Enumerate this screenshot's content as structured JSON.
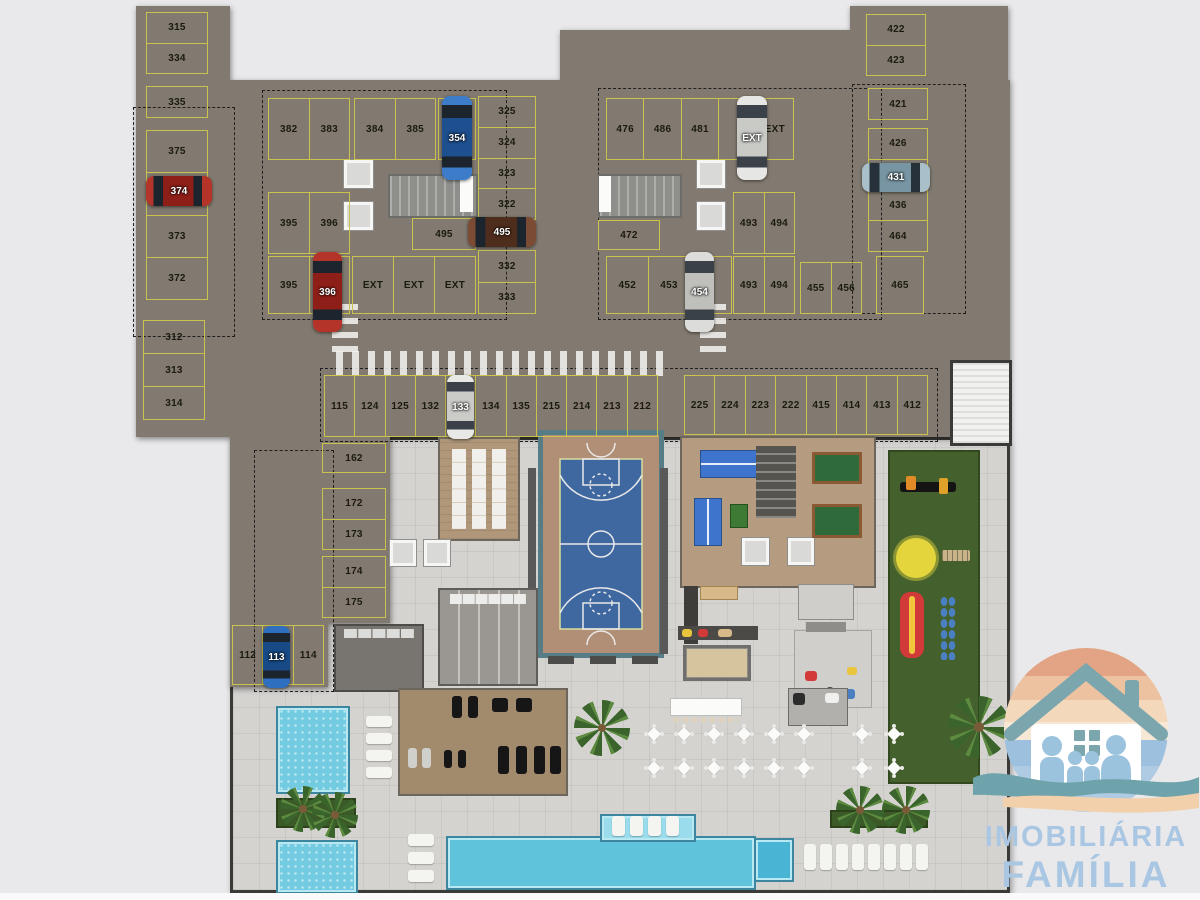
{
  "logo": {
    "line1": "IMOBILIÁRIA",
    "line2": "FAMÍLIA",
    "text_color": "#a9c7e2"
  },
  "colors": {
    "stall_line": "#c9c24c",
    "garage_floor": "#827a70",
    "deck_floor": "#d4d3d0",
    "pool_water": "#72cbe1",
    "court_blue": "#3f67a0",
    "court_tan": "#b18f76",
    "playground_green": "#44602c",
    "logo_text": "#a9c7e2"
  },
  "parking": {
    "groups": [
      {
        "name": "left-col-top",
        "x": 146,
        "y": 12,
        "w": 62,
        "h": 62,
        "dir": "col",
        "labels": [
          "315",
          "334"
        ]
      },
      {
        "name": "left-col-335",
        "x": 146,
        "y": 86,
        "w": 62,
        "h": 32,
        "dir": "col",
        "labels": [
          "335"
        ]
      },
      {
        "name": "left-col-mid",
        "x": 146,
        "y": 130,
        "w": 62,
        "h": 170,
        "dir": "col",
        "labels": [
          "375",
          "374",
          "373",
          "372"
        ]
      },
      {
        "name": "left-col-bottom",
        "x": 143,
        "y": 320,
        "w": 62,
        "h": 100,
        "dir": "col",
        "labels": [
          "312",
          "313",
          "314"
        ]
      },
      {
        "name": "blockL-row1a",
        "x": 268,
        "y": 98,
        "w": 82,
        "h": 62,
        "dir": "row",
        "labels": [
          "382",
          "383"
        ]
      },
      {
        "name": "blockL-row1b",
        "x": 354,
        "y": 98,
        "w": 82,
        "h": 62,
        "dir": "row",
        "labels": [
          "384",
          "385"
        ]
      },
      {
        "name": "blockL-354",
        "x": 438,
        "y": 98,
        "w": 38,
        "h": 62,
        "dir": "row",
        "labels": [
          ""
        ]
      },
      {
        "name": "blockL-row2",
        "x": 268,
        "y": 192,
        "w": 82,
        "h": 62,
        "dir": "row",
        "labels": [
          "395",
          "396"
        ]
      },
      {
        "name": "blockL-row3",
        "x": 268,
        "y": 256,
        "w": 82,
        "h": 58,
        "dir": "row",
        "labels": [
          "395",
          ""
        ]
      },
      {
        "name": "blockL-ext",
        "x": 352,
        "y": 256,
        "w": 124,
        "h": 58,
        "dir": "row",
        "labels": [
          "EXT",
          "EXT",
          "EXT"
        ]
      },
      {
        "name": "blockL-colR",
        "x": 478,
        "y": 96,
        "w": 58,
        "h": 124,
        "dir": "col",
        "labels": [
          "325",
          "324",
          "323",
          "322"
        ]
      },
      {
        "name": "blockL-495",
        "x": 412,
        "y": 218,
        "w": 64,
        "h": 32,
        "dir": "row",
        "labels": [
          "495"
        ]
      },
      {
        "name": "blockL-colR2",
        "x": 478,
        "y": 250,
        "w": 58,
        "h": 64,
        "dir": "col",
        "labels": [
          "332",
          "333"
        ]
      },
      {
        "name": "blockR-row1",
        "x": 606,
        "y": 98,
        "w": 188,
        "h": 62,
        "dir": "row",
        "labels": [
          "476",
          "486",
          "481",
          "",
          "EXT"
        ]
      },
      {
        "name": "blockR-472",
        "x": 598,
        "y": 220,
        "w": 62,
        "h": 30,
        "dir": "row",
        "labels": [
          "472"
        ]
      },
      {
        "name": "blockR-row3",
        "x": 606,
        "y": 256,
        "w": 126,
        "h": 58,
        "dir": "row",
        "labels": [
          "452",
          "453",
          ""
        ]
      },
      {
        "name": "blockR-493a",
        "x": 733,
        "y": 192,
        "w": 62,
        "h": 62,
        "dir": "row",
        "labels": [
          "493",
          "494"
        ]
      },
      {
        "name": "blockR-493b",
        "x": 733,
        "y": 256,
        "w": 62,
        "h": 58,
        "dir": "row",
        "labels": [
          "493",
          "494"
        ]
      },
      {
        "name": "blockR-455",
        "x": 800,
        "y": 262,
        "w": 62,
        "h": 52,
        "dir": "row",
        "labels": [
          "455",
          "456"
        ]
      },
      {
        "name": "blockR-465",
        "x": 876,
        "y": 256,
        "w": 48,
        "h": 58,
        "dir": "row",
        "labels": [
          "465"
        ]
      },
      {
        "name": "right-col-top",
        "x": 866,
        "y": 14,
        "w": 60,
        "h": 62,
        "dir": "col",
        "labels": [
          "422",
          "423"
        ]
      },
      {
        "name": "right-col-421",
        "x": 868,
        "y": 88,
        "w": 60,
        "h": 32,
        "dir": "col",
        "labels": [
          "421"
        ]
      },
      {
        "name": "right-col-mid",
        "x": 868,
        "y": 128,
        "w": 60,
        "h": 124,
        "dir": "col",
        "labels": [
          "426",
          "",
          "436",
          "464"
        ]
      },
      {
        "name": "mid-strip-left",
        "x": 324,
        "y": 375,
        "w": 334,
        "h": 62,
        "dir": "row",
        "labels": [
          "115",
          "124",
          "125",
          "132",
          "",
          "134",
          "135",
          "215",
          "214",
          "213",
          "212"
        ]
      },
      {
        "name": "mid-strip-right",
        "x": 684,
        "y": 375,
        "w": 244,
        "h": 60,
        "dir": "row",
        "labels": [
          "225",
          "224",
          "223",
          "222",
          "415",
          "414",
          "413",
          "412"
        ]
      },
      {
        "name": "low-162",
        "x": 322,
        "y": 443,
        "w": 64,
        "h": 30,
        "dir": "row",
        "labels": [
          "162"
        ]
      },
      {
        "name": "low-172",
        "x": 322,
        "y": 488,
        "w": 64,
        "h": 62,
        "dir": "col",
        "labels": [
          "172",
          "173"
        ]
      },
      {
        "name": "low-174",
        "x": 322,
        "y": 556,
        "w": 64,
        "h": 62,
        "dir": "col",
        "labels": [
          "174",
          "175"
        ]
      },
      {
        "name": "low-112",
        "x": 232,
        "y": 625,
        "w": 92,
        "h": 60,
        "dir": "row",
        "labels": [
          "112",
          "",
          "114"
        ]
      }
    ],
    "cars": [
      {
        "label": "374",
        "x": 146,
        "y": 176,
        "w": 66,
        "h": 30,
        "dir": "h",
        "body": "#b5342a",
        "roof": "#8e1f18",
        "glass": "#1c242e"
      },
      {
        "label": "354",
        "x": 442,
        "y": 96,
        "w": 30,
        "h": 84,
        "dir": "v",
        "body": "#3d7cc9",
        "roof": "#1e4f8e",
        "glass": "#1c242e"
      },
      {
        "label": "396",
        "x": 313,
        "y": 252,
        "w": 29,
        "h": 80,
        "dir": "v",
        "body": "#b5342a",
        "roof": "#8e1f18",
        "glass": "#1c242e"
      },
      {
        "label": "495",
        "x": 468,
        "y": 217,
        "w": 68,
        "h": 30,
        "dir": "h",
        "body": "#7b4b33",
        "roof": "#4f2d1d",
        "glass": "#1c242e"
      },
      {
        "label": "EXT",
        "x": 737,
        "y": 96,
        "w": 30,
        "h": 84,
        "dir": "v",
        "body": "#e6e6e4",
        "roof": "#c9c9c6",
        "glass": "#3a4148"
      },
      {
        "label": "454",
        "x": 685,
        "y": 252,
        "w": 29,
        "h": 80,
        "dir": "v",
        "body": "#dcdcda",
        "roof": "#bfbfbc",
        "glass": "#3a4148"
      },
      {
        "label": "431",
        "x": 862,
        "y": 163,
        "w": 68,
        "h": 29,
        "dir": "h",
        "body": "#a9bfc9",
        "roof": "#7795a3",
        "glass": "#27313a"
      },
      {
        "label": "133",
        "x": 447,
        "y": 375,
        "w": 27,
        "h": 64,
        "dir": "v",
        "body": "#e8e8e6",
        "roof": "#cbcbc8",
        "glass": "#3a4148"
      },
      {
        "label": "113",
        "x": 263,
        "y": 626,
        "w": 27,
        "h": 62,
        "dir": "v",
        "body": "#2f6fc0",
        "roof": "#174a86",
        "glass": "#1c242e"
      }
    ]
  }
}
